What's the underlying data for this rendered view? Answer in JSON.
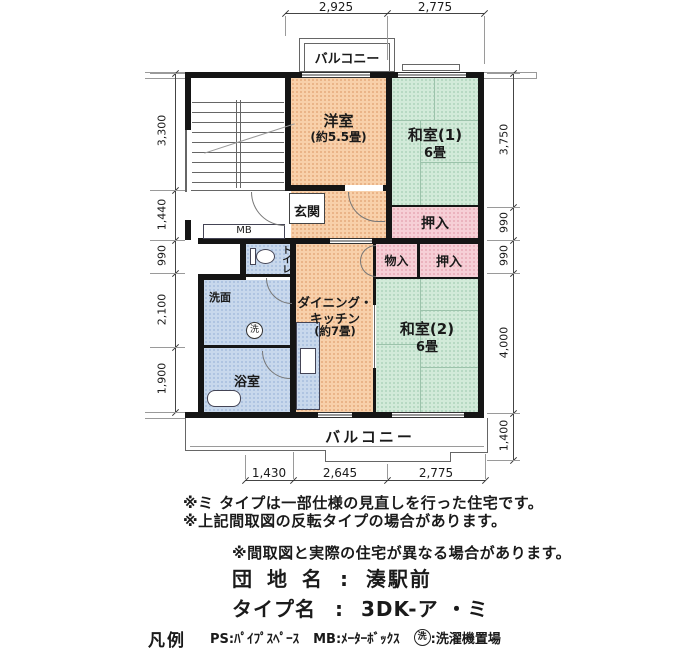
{
  "plan": {
    "rooms": {
      "yoshitsu": {
        "name": "洋室",
        "size": "(約5.5畳)"
      },
      "washitsu1": {
        "name": "和室(1)",
        "size": "6畳"
      },
      "washitsu2": {
        "name": "和室(2)",
        "size": "6畳"
      },
      "dk": {
        "line1": "ダイニング・",
        "line2": "キッチン",
        "line3": "(約7畳)"
      },
      "genkan": "玄関",
      "toilet": "トイレ",
      "senmen": "洗面",
      "bath": "浴室",
      "oshiire_upper": "押入",
      "oshiire_lower": "押入",
      "monoire": "物入",
      "mb": "MB",
      "laundry_mark": "洗",
      "balcony_top": "バルコニー",
      "balcony_bottom": "バルコニー"
    },
    "dims": {
      "top": [
        "2,925",
        "2,775"
      ],
      "left": [
        "3,300",
        "1,440",
        "990",
        "2,100",
        "1,900"
      ],
      "right": [
        "3,750",
        "990",
        "990",
        "4,000",
        "1,400"
      ],
      "bottom": [
        "1,430",
        "2,645",
        "2,775"
      ]
    }
  },
  "notes": [
    "※ミ タイプは一部仕様の見直しを行った住宅です。",
    "※上記間取図の反転タイプの場合があります。",
    "※間取図と実際の住宅が異なる場合があります。"
  ],
  "info": {
    "site_label": "団 地 名",
    "site_colon": ":",
    "site_value": "湊駅前",
    "type_label": "タイプ名",
    "type_colon": ":",
    "type_value": "3DK-ア ・ミ"
  },
  "legend": {
    "title": "凡例",
    "ps": "PS:ﾊﾟｲﾌﾟｽﾍﾟｰｽ",
    "mb": "MB:ﾒｰﾀｰﾎﾞｯｸｽ",
    "laundry_mark": "洗",
    "laundry_text": ":洗濯機置場"
  },
  "colors": {
    "wall": "#151515",
    "peach": "#f8d0aa",
    "green": "#d2ead9",
    "pink": "#f6cfd6",
    "blue": "#c8d8ec"
  }
}
